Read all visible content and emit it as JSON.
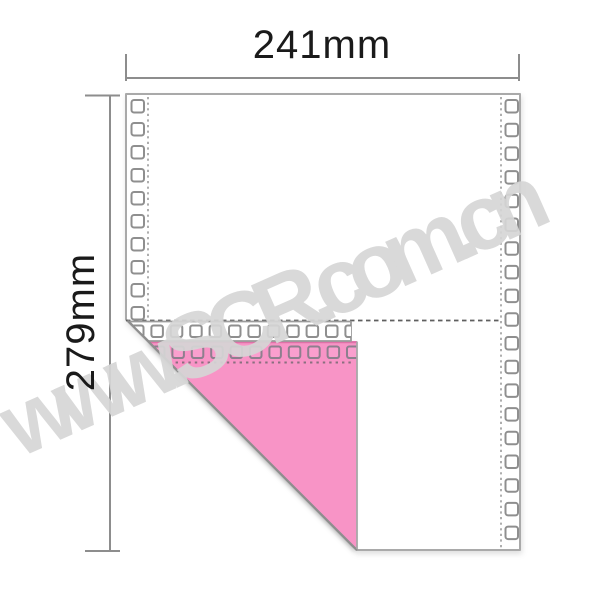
{
  "diagram": {
    "type": "2-ply continuous form paper with folded corner",
    "width_label": "241mm",
    "height_label": "279mm"
  },
  "watermark": {
    "text": "www.SCR.com.cn"
  },
  "colors": {
    "paper": "#ffffff",
    "paper_border": "#a9a9a9",
    "hole_border": "#8f8f8f",
    "copy_pink": "#f894c6",
    "copy_pink_hole": "#fa9fce",
    "copy_pink_hole_border": "#8e7f8e",
    "dimension_line": "#8d8d8d",
    "label_text": "#1a1a1a",
    "watermark_gray": "#d6d6d6"
  }
}
